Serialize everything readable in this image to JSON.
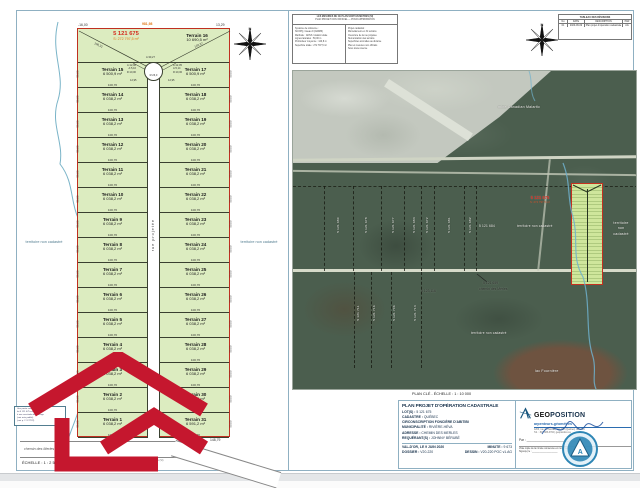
{
  "colors": {
    "lot_green": "#dcecc0",
    "plan_red": "#c03020",
    "accent_orange": "#e07818",
    "logo_red": "#c5172e",
    "photo_green": "#4b5e4e",
    "brand_blue": "#2b6cb0"
  },
  "left_plan": {
    "scale_label": "ÉCHELLE : 1 : 2 500",
    "footnote": "N.B. Les mesures indiquées au plan sont en mètres (SI)",
    "header": {
      "lot_number": "5 121 675",
      "lot_area": "S: 272 797,5 m²",
      "terrain16_name": "Terrain 16",
      "terrain16_area": "10 690,5 m²",
      "dim_left": "-16,00",
      "dim_top": "981,98",
      "dim_right": "13,29",
      "diag_left": "109,31",
      "diag_right": "120,37",
      "arc_left_1": "A:12,06",
      "arc_left_2": "A:5,16",
      "arc_left_3": "R:10,00",
      "arc_right_1": "A:12,05",
      "arc_right_2": "A:5,14",
      "arc_right_3": "R:10,00",
      "arc_top": "A:30,27",
      "circle_radius": "R:26,0",
      "offset_left": "12,95",
      "offset_right": "12,95"
    },
    "street_label": "rue projetée",
    "road_label": "chemin des Merles",
    "territory_left": "territoire non cadastré",
    "territory_right": "territoire non cadastré",
    "bottom_dim_orange": "291,30",
    "bottom_dim_black": "148,79",
    "note_lines": [
      "Une partie constitutive du",
      "lot 5 121 675 est soumise",
      "à une servitude de passage",
      "(voir acte publié)",
      "(voir p. 2 / F7722)"
    ],
    "rows": [
      {
        "left_name": "Terrain 15",
        "left_area": "6 500,9 m²",
        "right_name": "Terrain 17",
        "right_area": "6 500,9 m²",
        "dim": "100,76",
        "side": "50,00"
      },
      {
        "left_name": "Terrain 14",
        "left_area": "6 038,2 m²",
        "right_name": "Terrain 18",
        "right_area": "6 038,2 m²",
        "dim": "100,76",
        "side": "50,00"
      },
      {
        "left_name": "Terrain 13",
        "left_area": "6 038,2 m²",
        "right_name": "Terrain 19",
        "right_area": "6 038,2 m²",
        "dim": "100,76",
        "side": "50,00"
      },
      {
        "left_name": "Terrain 12",
        "left_area": "6 038,2 m²",
        "right_name": "Terrain 20",
        "right_area": "6 038,2 m²",
        "dim": "100,76",
        "side": "50,00"
      },
      {
        "left_name": "Terrain 11",
        "left_area": "6 038,2 m²",
        "right_name": "Terrain 21",
        "right_area": "6 038,2 m²",
        "dim": "100,76",
        "side": "50,00"
      },
      {
        "left_name": "Terrain 10",
        "left_area": "6 038,2 m²",
        "right_name": "Terrain 22",
        "right_area": "6 038,2 m²",
        "dim": "100,76",
        "side": "50,00"
      },
      {
        "left_name": "Terrain 9",
        "left_area": "6 038,2 m²",
        "right_name": "Terrain 23",
        "right_area": "6 038,2 m²",
        "dim": "100,76",
        "side": "50,00"
      },
      {
        "left_name": "Terrain 8",
        "left_area": "6 038,2 m²",
        "right_name": "Terrain 24",
        "right_area": "6 038,2 m²",
        "dim": "100,76",
        "side": "50,00"
      },
      {
        "left_name": "Terrain 7",
        "left_area": "6 038,2 m²",
        "right_name": "Terrain 25",
        "right_area": "6 038,2 m²",
        "dim": "100,76",
        "side": "50,00"
      },
      {
        "left_name": "Terrain 6",
        "left_area": "6 038,2 m²",
        "right_name": "Terrain 26",
        "right_area": "6 038,2 m²",
        "dim": "100,76",
        "side": "50,00"
      },
      {
        "left_name": "Terrain 5",
        "left_area": "6 038,2 m²",
        "right_name": "Terrain 27",
        "right_area": "6 038,2 m²",
        "dim": "100,76",
        "side": "50,00"
      },
      {
        "left_name": "Terrain 4",
        "left_area": "6 038,2 m²",
        "right_name": "Terrain 28",
        "right_area": "6 038,2 m²",
        "dim": "100,76",
        "side": "50,00"
      },
      {
        "left_name": "Terrain 3",
        "left_area": "6 038,2 m²",
        "right_name": "Terrain 29",
        "right_area": "6 038,2 m²",
        "dim": "100,76",
        "side": "50,00"
      },
      {
        "left_name": "Terrain 2",
        "left_area": "6 038,2 m²",
        "right_name": "Terrain 30",
        "right_area": "6 038,2 m²",
        "dim": "100,76",
        "side": "50,00"
      },
      {
        "left_name": "Terrain 1",
        "left_area": "6 038,2 m²",
        "right_name": "Terrain 31",
        "right_area": "6 591,2 m²",
        "dim": "100,76",
        "side": "50,00"
      }
    ]
  },
  "info_box": {
    "header_1": "LES MESURES DE CE PLAN SONT EN MÈTRES (SI)",
    "header_2": "PLAN PROJET NON OFFICIEL — POUR APPROBATION",
    "left_lines": [
      "Système de référence :",
      "SCOPQ, fuseau 9 (NAD83)",
      "Méthode : GNSS / station totale",
      "Lignes latérales : 50,00 m",
      "Profondeur moyenne : 120,8 m",
      "Superficie totale : 272 797,5 m²"
    ],
    "right_lines": [
      "Projet cadastral :",
      "Morcellement en 31 terrains",
      "Ouverture de la rue projetée",
      "Numérotation des terrains",
      "Superficies arrondies au dixième",
      "Plan et mesures non officiels",
      "Sous toute réserve"
    ]
  },
  "rev_table": {
    "title": "TABLEAU DES RÉVISIONS",
    "col_no": "No",
    "col_date": "DATE",
    "col_desc": "DESCRIPTION",
    "col_par": "PAR",
    "row_no": "01",
    "row_date": "2020-06-09",
    "row_desc": "Plan projet d'opération cadastrale",
    "row_par": "AG"
  },
  "right_panel": {
    "caption": "PLAN CLÉ - ÉCHELLE : 1 : 10 000",
    "mine_label": "mine Canadian Malartic",
    "lots": [
      "5 121 680",
      "5 121 678",
      "5 121 677",
      "5 121 683",
      "5 121 672",
      "5 121 681",
      "5 121 682"
    ],
    "lot_684": "5 121 684",
    "territory_mid": "territoire non cadastré",
    "red_lot": "5 121 675",
    "red_area": "S: 272 797,5 m²",
    "territory_right_1": "territoire",
    "territory_right_2": "non",
    "territory_right_3": "cadastré",
    "road_lot": "5 121 659",
    "road_name": "chemin des Merles",
    "lot_3116": "5 123 116",
    "lower_lots": [
      "5 121 711",
      "5 121 716",
      "5 121 706",
      "5 121 713"
    ],
    "territory_lower": "territoire non cadastré",
    "lake_label": "lac Fournière"
  },
  "title_block": {
    "title": "PLAN PROJET D'OPÉRATION CADASTRALE",
    "lots_label": "LOT(S) :",
    "lots_value": "5 121 675",
    "cadastre_label": "CADASTRE :",
    "cadastre_value": "QUÉBEC",
    "circ_line": "CIRCONSCRIPTION FONCIÈRE D'ABITIBI",
    "mun_label": "MUNICIPALITÉ :",
    "mun_value": "RIVIÈRE-HÉVA",
    "addr_label": "ADRESSE :",
    "addr_value": "CHEMIN DES MERLES",
    "req_label": "REQUÉRANT(S) :",
    "req_value": "JOHNNY BÉRUBÉ",
    "date_line": "VAL-D'OR, LE 9 JUIN 2020",
    "minute_label": "MINUTE :",
    "minute_value": "9 673",
    "dossier_label": "DOSSIER :",
    "dossier_value": "V20-220",
    "dessin_label": "DESSIN :",
    "dessin_value": "V20-220 POC v1.AG",
    "firm_name_1": "GEO",
    "firm_name_2": "POSITION",
    "firm_sub": "arpenteurs-géomètres",
    "firm_addr_1": "1263, rue de l'Escale, Val-d'Or (Québec) J9P 4G4",
    "firm_addr_2": "Tél. : 819 825-3702  |  geoposition.ca",
    "par_label": "Par :",
    "copy_note_1": "Vraie copie de la minute conservée en mon greffe",
    "copy_note_2": "Signé(e) le :"
  },
  "compass": {
    "n": "N",
    "s": "S",
    "e": "E",
    "o": "O"
  }
}
